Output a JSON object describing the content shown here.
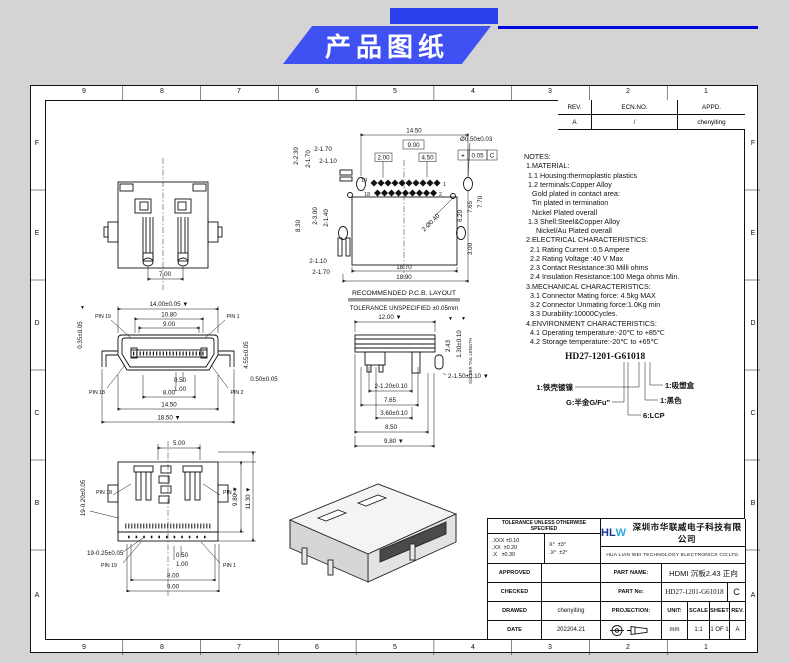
{
  "banner": {
    "title": "产品图纸"
  },
  "frame": {
    "cols": [
      "9",
      "8",
      "7",
      "6",
      "5",
      "4",
      "3",
      "2",
      "1"
    ],
    "rows": [
      "F",
      "E",
      "D",
      "C",
      "B",
      "A"
    ]
  },
  "revision": {
    "h_rev": "REV.",
    "h_ecn": "ECN.NO.",
    "h_appd": "APPD.",
    "rev": "A",
    "ecn": "/",
    "appd": "chenyiting"
  },
  "notes": {
    "lines": [
      "NOTES:",
      " 1.MATERIAL:",
      "  1.1 Housing:thermoplastic plastics",
      "  1.2 terminals:Copper Alloy",
      "    Gold plated in contact area:",
      "    Tin plated in termination",
      "    Nickel Plated overall",
      "  1.3 Shell:Steel&Copper Alloy",
      "      Nickel/Au Plated overall",
      " 2.ELECTRICAL CHARACTERISTICS:",
      "   2.1 Rating Current :0.5 Ampere",
      "   2.2 Rating Voltage :40 V Max",
      "   2.3 Contact Resistance:30 Milli ohms",
      "   2.4 Insulation Resistance:100 Mega ohms Min.",
      " 3.MECHANICAL CHARACTERISTICS:",
      "   3.1 Connector Mating force: 4.5kg MAX",
      "   3.2 Connector Unmating force:1.0Kg min",
      "   3.3 Durability:10000Cycles.",
      " 4.ENVIRONMENT CHARACTERISTICS:",
      "   4.1 Operating temperature:-20℃ to +85℃",
      "   4.2 Storage temperature:-20℃ to +65℃"
    ]
  },
  "decoder": {
    "code": "HD27-1201-G61018",
    "shell": "1:铁壳镀镍",
    "plating": "G:半金G/Fu″",
    "lcp": "6:LCP",
    "color": "1:黑色",
    "packing": "1:吸塑盒"
  },
  "views": {
    "rear": {
      "w": "7.00"
    },
    "pcb": {
      "caption": "RECOMMENDED  P.C.B.  LAYOUT",
      "tol": "TOLERANCE UNSPECIFIED ±0.05mm",
      "d_top": "14.50",
      "box_mid": "9.00",
      "box_l": "2.00",
      "box_r": "4.50",
      "tl1": "2-1.70",
      "tl2": "2-1.10",
      "tv1": "2-2.30",
      "tv2": "2-1.70",
      "ml1": "8.30",
      "ml2": "2-3.00",
      "ml3": "2-1.40",
      "bl1": "2-1.10",
      "bl2": "2-1.70",
      "hole": "Ø0.50±0.03",
      "fcf_sym": "⌖",
      "fcf_val": "0.05",
      "fcf_d": "C",
      "r1": "6.20",
      "r2": "7.65",
      "r3": "7.70",
      "r4": "3.00",
      "diag": "2-Ø0.40",
      "b1": "18.70",
      "b2": "18.90",
      "p19": "19",
      "p1": "1",
      "p18": "18",
      "p2": "2"
    },
    "front": {
      "d1": "14.00±0.05 ▼",
      "d2": "10.80",
      "d3": "9.00",
      "lv": "0.35±0.05",
      "rv": "4.55±0.05",
      "r2": "0.50±0.05",
      "c1": "0.50",
      "c2": "1.00",
      "b1": "8.00",
      "b2": "14.50",
      "b3": "18.50 ▼",
      "p19": "PIN 19",
      "p1": "PIN 1",
      "p18": "PIN 18",
      "p2": "PIN 2",
      "tri": "▼"
    },
    "side": {
      "top": "12.00 ▼",
      "v1": "2.43",
      "v2": "1.30±0.10",
      "note": "SOLDER TAIL LENGTH",
      "r1": "2-1.50±0.10 ▼",
      "d1": "2-1.20±0.10",
      "d2": "7.65",
      "d3": "3.60±0.10",
      "d4": "8.50",
      "d5": "9.80 ▼",
      "tri": "▼"
    },
    "bottom": {
      "top": "5.00",
      "lv": "19-0.20±0.05",
      "l2": "19-0.25±0.05",
      "rv1": "9.80 ▼",
      "rv2": "11.30 ▼",
      "c1": "0.50",
      "c2": "1.00",
      "b1": "8.00",
      "b2": "9.00",
      "p18": "PIN 18",
      "p2": "PIN 2",
      "p19": "PIN 19",
      "p1": "PIN 1"
    }
  },
  "titleblock": {
    "tol_title": "TOLERANCE UNLESS OTHERWISE SPECIFIED",
    "tol1": ".XXX ±0.10",
    "tol2": ".XX  ±0.20",
    "tol3": ".X   ±0.30",
    "ang1": "X°  ±3°",
    "ang2": ".X°  ±2°",
    "logo": "HLW",
    "company_cn": "深圳市华联威电子科技有限公司",
    "company_en": "HUA LIAN WEI TECHNOLOGY ELECTRONICS CO;LTD.",
    "approved": "APPROVED",
    "checked": "CHECKED",
    "drawed": "DRAWED",
    "date_l": "DATE",
    "part_name_l": "PART NAME:",
    "part_no_l": "PART No:",
    "projection_l": "PROJECTION:",
    "unit_l": "UNIT:",
    "scale_l": "SCALE",
    "sheet_l": "SHEET",
    "rev_l": "REV.",
    "part_name": "HDMI 沉板2.43 正向",
    "part_no": "HD27-1201-G61018",
    "rev_big": "C",
    "drawed_by": "chenyiting",
    "date": "202204.21",
    "unit": "mm",
    "scale": "1:1",
    "sheet": "1 OF 1",
    "rev": "A"
  }
}
